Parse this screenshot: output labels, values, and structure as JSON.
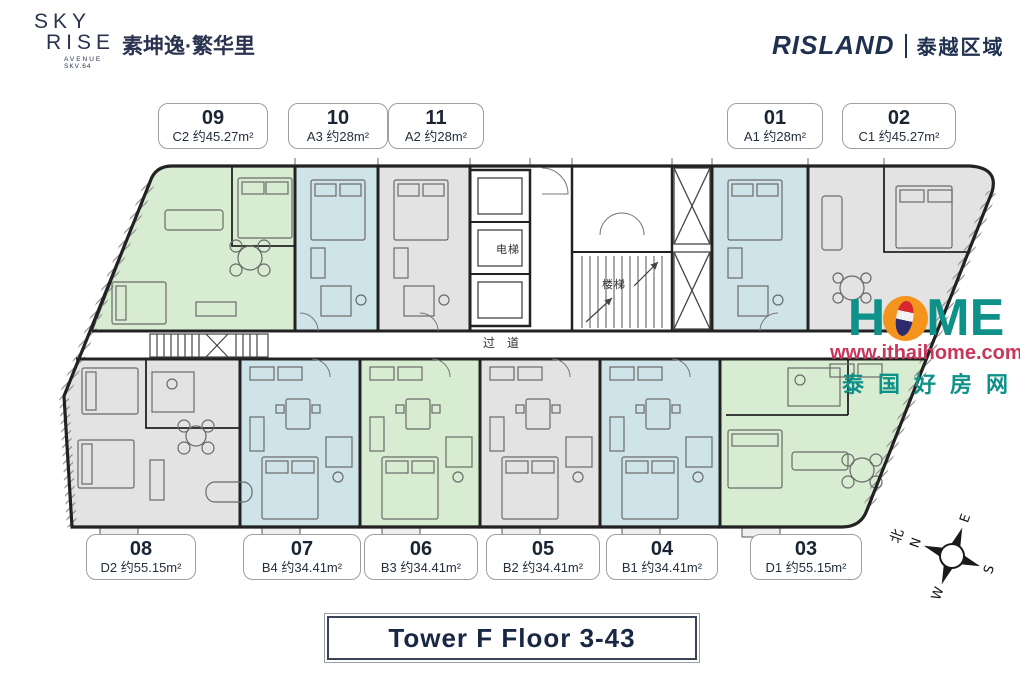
{
  "header": {
    "logo_sky": "SKY",
    "logo_rise": "RISE",
    "logo_sub1": "AVENUE",
    "logo_sub2": "SKV.64",
    "project_name": "素坤逸·繁华里",
    "brand": "RISLAND",
    "brand_region": "泰越区域"
  },
  "plan_labels": {
    "elevator": "电梯",
    "stairs": "楼梯",
    "corridor": "过道"
  },
  "units_top": [
    {
      "number": "09",
      "label": "C2 约45.27m²",
      "color": "#d8ecd2"
    },
    {
      "number": "10",
      "label": "A3 约28m²",
      "color": "#cfe4e9"
    },
    {
      "number": "11",
      "label": "A2 约28m²",
      "color": "#e3e3e3"
    },
    {
      "number": "01",
      "label": "A1 约28m²",
      "color": "#cfe4e9"
    },
    {
      "number": "02",
      "label": "C1 约45.27m²",
      "color": "#e3e3e3"
    }
  ],
  "units_bottom": [
    {
      "number": "08",
      "label": "D2 约55.15m²",
      "color": "#e3e3e3"
    },
    {
      "number": "07",
      "label": "B4 约34.41m²",
      "color": "#cfe4e9"
    },
    {
      "number": "06",
      "label": "B3 约34.41m²",
      "color": "#d8ecd2"
    },
    {
      "number": "05",
      "label": "B2 约34.41m²",
      "color": "#e3e3e3"
    },
    {
      "number": "04",
      "label": "B1 约34.41m²",
      "color": "#cfe4e9"
    },
    {
      "number": "03",
      "label": "D1 约55.15m²",
      "color": "#d8ecd2"
    }
  ],
  "watermark": {
    "brand_h": "H",
    "brand_me": "ME",
    "url": "www.ithaihome.com",
    "slogan_cn": "泰国好房网"
  },
  "compass": {
    "n": "N",
    "e": "E",
    "s": "S",
    "w": "W",
    "north_label": "北"
  },
  "footer": {
    "title": "Tower F Floor 3-43"
  },
  "colors": {
    "unit_green": "#d8ecd2",
    "unit_blue": "#cfe4e9",
    "unit_gray": "#e3e3e3",
    "brand_navy": "#22304c",
    "watermark_teal": "#0d9188",
    "watermark_red": "#c9365a",
    "watermark_orange": "#f5941d"
  }
}
